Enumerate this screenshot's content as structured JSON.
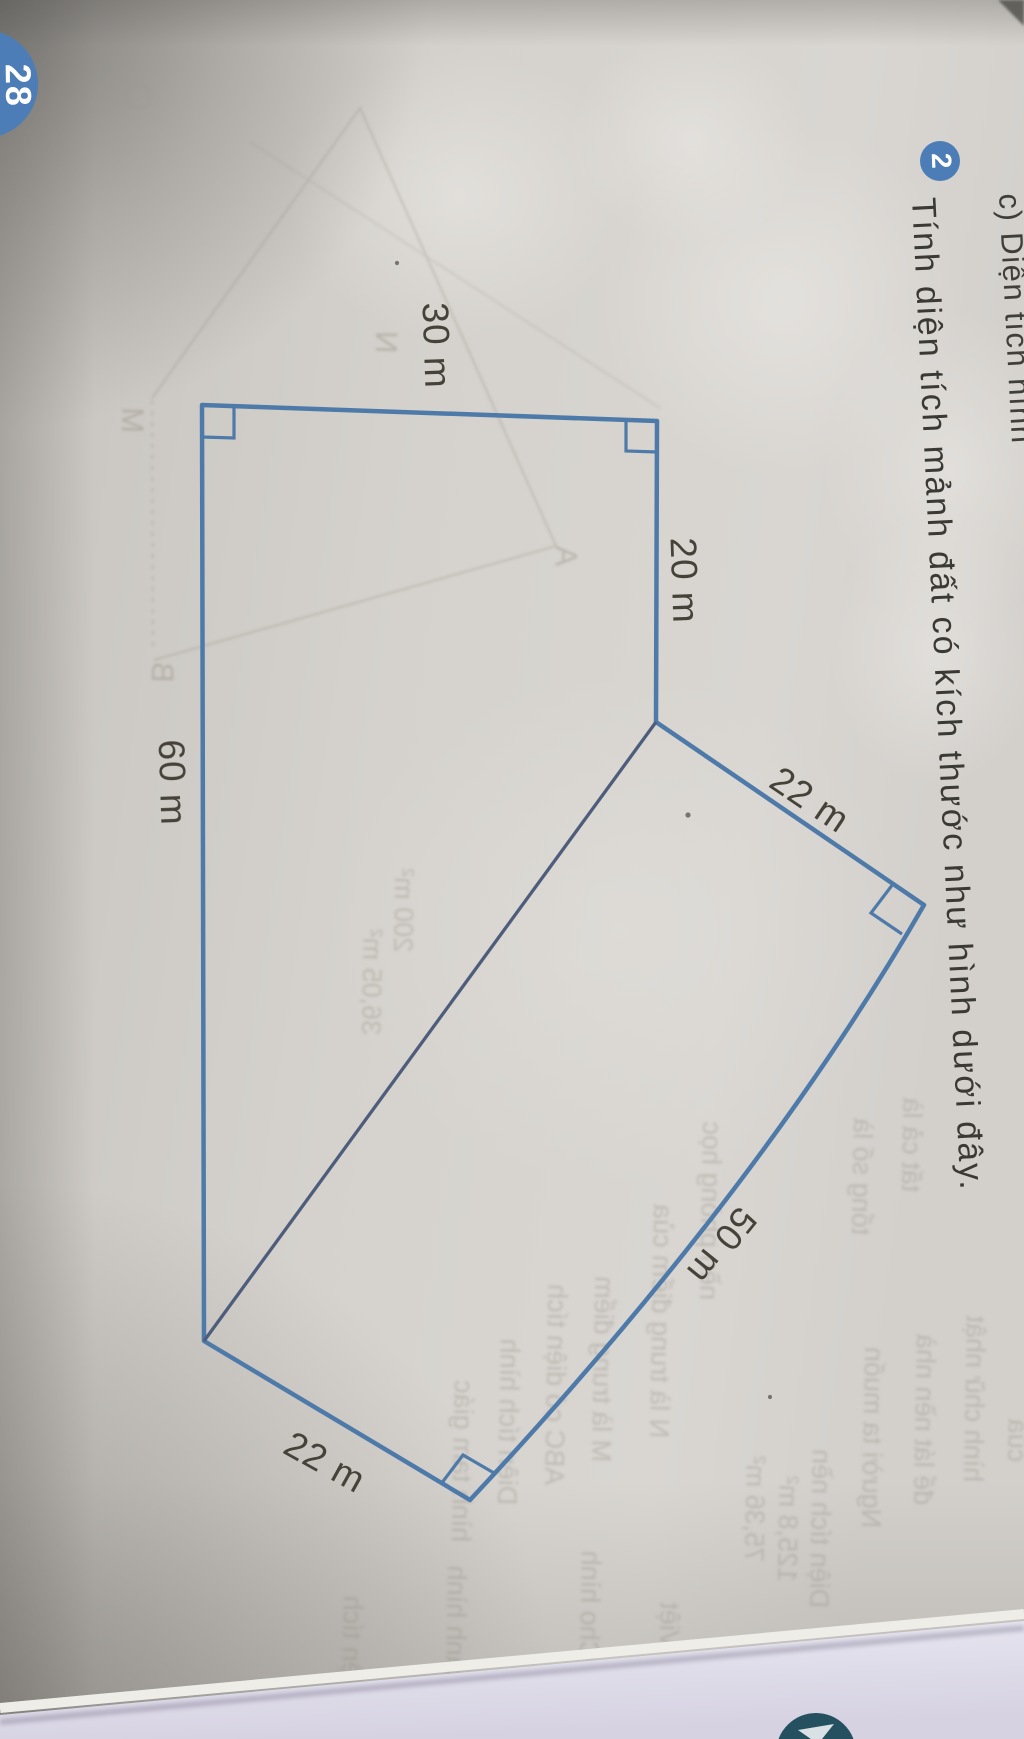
{
  "problem": {
    "badge": "2",
    "text": "Tính diện tích mảnh đất có kích thước như hình dưới đây."
  },
  "previous_item": {
    "text": "c) Diện tích hình"
  },
  "page_badge": {
    "number": "28"
  },
  "figure": {
    "side_labels": {
      "top": "30 m",
      "right": "20 m",
      "upper_diagonal": "22 m",
      "long_diagonal": "50 m",
      "bottom": "22 m",
      "left": "60 m"
    }
  },
  "showthrough": {
    "letters": [
      "M",
      "B",
      "A",
      "N"
    ],
    "snippets": [
      "36,05 m²",
      "200 m²",
      "hình tam giác",
      "Diện tích hình",
      "ABC có diện tích",
      "M là trung điểm",
      "N là trung điểm của",
      "nền phòng học",
      "tổng số là",
      "tất cả là",
      "75,36 m²",
      "125,8 m²",
      "Diện tích nền",
      "Người ta muốn",
      "để lát nền nhà",
      "hình chữ nhật",
      "của",
      "Diện tích",
      "cạnh hình",
      "Cho hình",
      "Việt"
    ]
  },
  "colors": {
    "figure_line": "#4e7aa9",
    "divider_line": "#4e5d7b",
    "label_text": "#45423a",
    "body_text": "#3b3934",
    "badge_blue": "#4c7db6",
    "page": "#d2cfca",
    "table": "#e9e6f1",
    "teal_badge": "#24505f"
  }
}
